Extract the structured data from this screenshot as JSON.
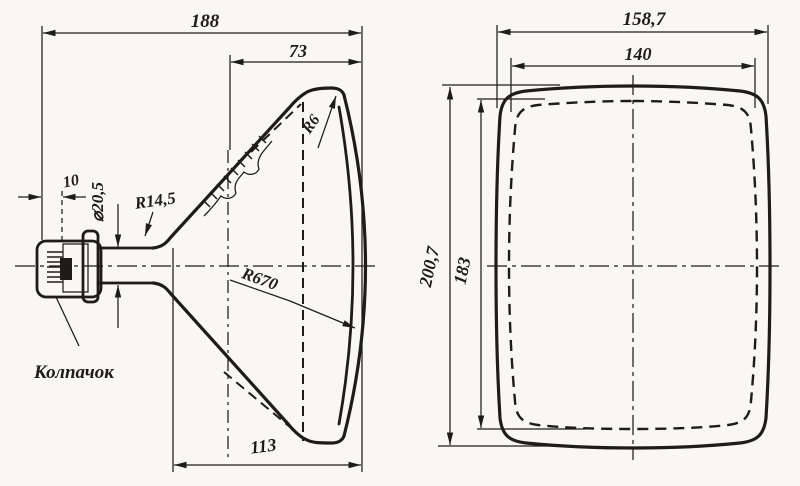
{
  "drawing": {
    "background_color": "#f8f7f2",
    "ink_color": "#1d1c1a",
    "side_view": {
      "dim_overall_length": "188",
      "dim_face_depth": "73",
      "dim_cap_offset": "10",
      "dim_neck_diameter": "⌀20,5",
      "radius_neck_fillet": "R14,5",
      "radius_face_corner": "R6",
      "radius_screen_face": "R670",
      "dim_cone_length": "113",
      "label_cap": "Колпачок"
    },
    "front_view": {
      "dim_width_outer": "158,7",
      "dim_width_inner": "140",
      "dim_height_outer": "200,7",
      "dim_height_inner": "183"
    }
  }
}
